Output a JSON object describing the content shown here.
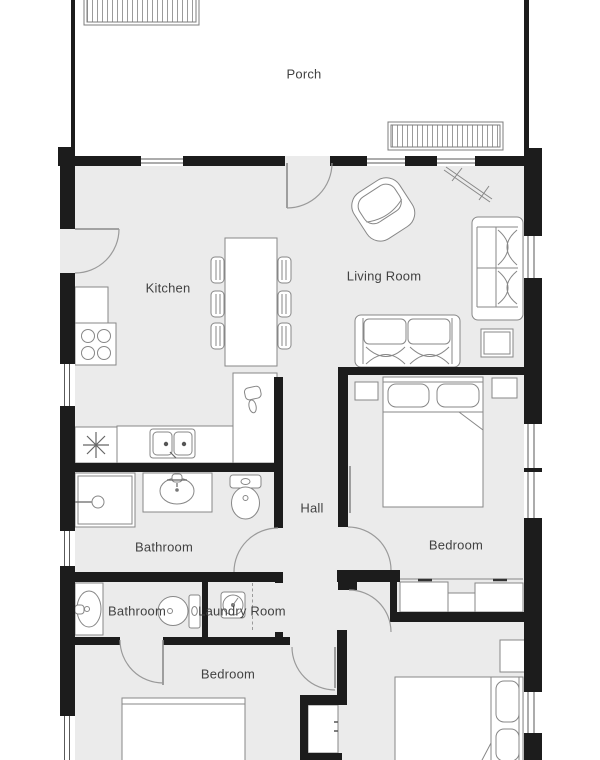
{
  "title": "Apartment floor plan",
  "theme": {
    "wall_color": "#1c1c1c",
    "floor_color": "#ebebeb",
    "line_color": "#878787",
    "label_color": "#424242",
    "background": "#ffffff"
  },
  "rooms": [
    {
      "name": "porch",
      "label": "Porch"
    },
    {
      "name": "kitchen",
      "label": "Kitchen"
    },
    {
      "name": "living-room",
      "label": "Living Room"
    },
    {
      "name": "hall",
      "label": "Hall"
    },
    {
      "name": "bathroom-1",
      "label": "Bathroom"
    },
    {
      "name": "bedroom-master",
      "label": "Bedroom"
    },
    {
      "name": "bathroom-2",
      "label": "Bathroom"
    },
    {
      "name": "laundry-room",
      "label": "Laundry Room"
    },
    {
      "name": "bedroom-2",
      "label": "Bedroom"
    }
  ],
  "fixtures": [
    "porch-steps",
    "entry-door",
    "stove-icon",
    "fridge-icon",
    "kitchen-double-sink-icon",
    "dining-table",
    "dining-chairs",
    "armchair-icon",
    "sofa-icon",
    "loveseat-icon",
    "side-table",
    "prep-sink-icon",
    "shower-icon",
    "pedestal-sink-icon",
    "toilet-icon",
    "washing-machine-icon",
    "double-bed-icon",
    "single-bed-icon",
    "nightstand",
    "wardrobe",
    "closet"
  ]
}
